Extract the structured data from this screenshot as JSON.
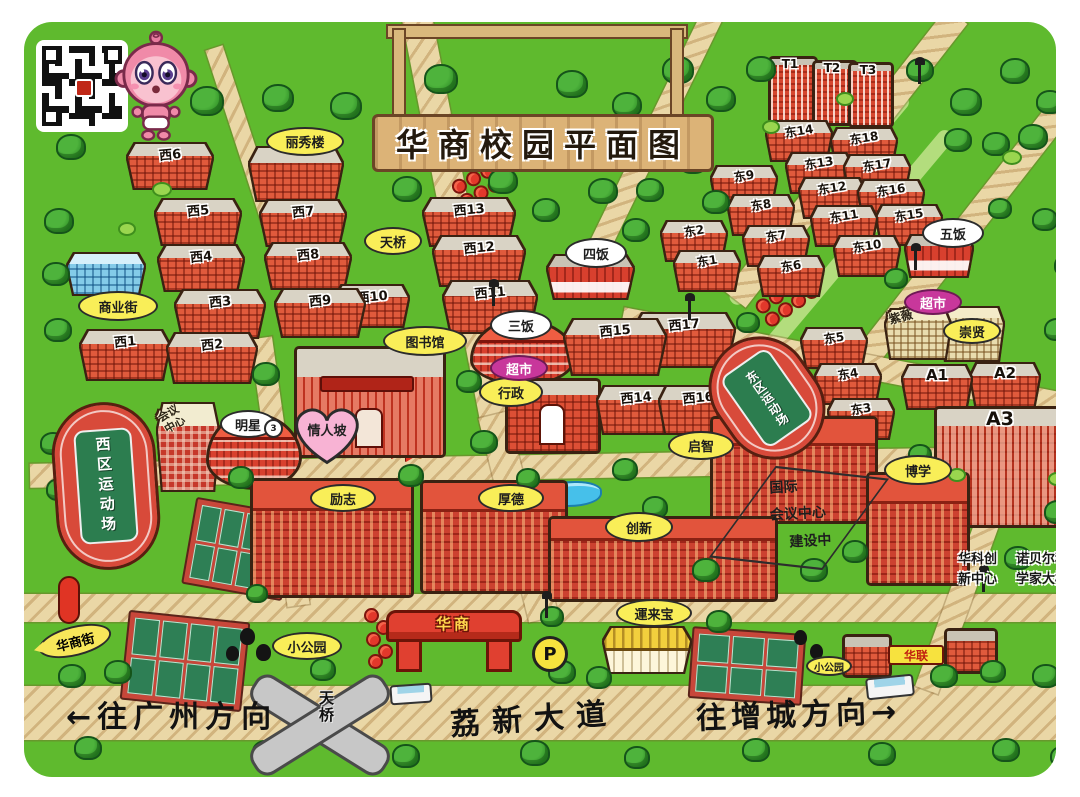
{
  "sign": {
    "title": "华商校园平面图"
  },
  "gate": {
    "label": "华商"
  },
  "parking": {
    "label": "P"
  },
  "bridge": {
    "label": "天桥"
  },
  "road_labels": {
    "to_guangzhou": "←往广州方向",
    "avenue": "荔新大道",
    "to_zengcheng": "往增城方向→"
  },
  "labels_special": {
    "lovers_slope": "情人坡",
    "huashang_street": "华商街"
  },
  "conference_center": {
    "lines": [
      "国际",
      "会议中心",
      "建设中"
    ]
  },
  "annotations": {
    "huake": [
      "华科创",
      "新中心"
    ],
    "nobel": [
      "诺贝尔科",
      "学家大楼"
    ]
  },
  "fields": [
    {
      "label": "西区运动场"
    },
    {
      "label": "东区运动场"
    }
  ],
  "colors": {
    "grass": "#5fba2e",
    "road": "#ead7a6",
    "building_red": "#e05a3c",
    "bubble_yellow": "#f9ee58",
    "bubble_purple": "#c8379b",
    "track_red": "#d84a3a"
  },
  "buildings": [
    {
      "n": "T1",
      "x": 768,
      "y": 56,
      "w": 44,
      "h": 62,
      "s": "t"
    },
    {
      "n": "T2",
      "x": 812,
      "y": 60,
      "w": 40,
      "h": 60,
      "s": "t"
    },
    {
      "n": "T3",
      "x": 848,
      "y": 62,
      "w": 40,
      "h": 60,
      "s": "t"
    },
    {
      "n": "西6",
      "x": 128,
      "y": 144,
      "w": 84,
      "h": 44,
      "s": "w"
    },
    {
      "n": "",
      "x": 250,
      "y": 148,
      "w": 92,
      "h": 52,
      "s": "w"
    },
    {
      "n": "西5",
      "x": 156,
      "y": 200,
      "w": 84,
      "h": 44,
      "s": "w"
    },
    {
      "n": "西7",
      "x": 261,
      "y": 201,
      "w": 84,
      "h": 44,
      "s": "w"
    },
    {
      "n": "西4",
      "x": 159,
      "y": 246,
      "w": 84,
      "h": 44,
      "s": "w"
    },
    {
      "n": "西8",
      "x": 266,
      "y": 244,
      "w": 84,
      "h": 44,
      "s": "w"
    },
    {
      "n": "",
      "x": 68,
      "y": 254,
      "w": 76,
      "h": 40,
      "s": "blue"
    },
    {
      "n": "西3",
      "x": 176,
      "y": 291,
      "w": 88,
      "h": 46,
      "s": "w"
    },
    {
      "n": "西9",
      "x": 276,
      "y": 290,
      "w": 88,
      "h": 46,
      "s": "w"
    },
    {
      "n": "西10",
      "x": 336,
      "y": 286,
      "w": 72,
      "h": 40,
      "s": "w"
    },
    {
      "n": "西1",
      "x": 81,
      "y": 331,
      "w": 88,
      "h": 48,
      "s": "w"
    },
    {
      "n": "西2",
      "x": 168,
      "y": 334,
      "w": 88,
      "h": 48,
      "s": "w"
    },
    {
      "n": "西13",
      "x": 424,
      "y": 199,
      "w": 90,
      "h": 46,
      "s": "w"
    },
    {
      "n": "西12",
      "x": 434,
      "y": 237,
      "w": 90,
      "h": 48,
      "s": "w"
    },
    {
      "n": "西11",
      "x": 444,
      "y": 282,
      "w": 92,
      "h": 50,
      "s": "w"
    },
    {
      "n": "西15",
      "x": 565,
      "y": 320,
      "w": 100,
      "h": 54,
      "s": "w"
    },
    {
      "n": "西17",
      "x": 634,
      "y": 314,
      "w": 100,
      "h": 52,
      "s": "w"
    },
    {
      "n": "西14",
      "x": 598,
      "y": 387,
      "w": 76,
      "h": 46,
      "s": "w"
    },
    {
      "n": "西16",
      "x": 660,
      "y": 387,
      "w": 76,
      "h": 46,
      "s": "w"
    },
    {
      "n": "东14",
      "x": 767,
      "y": 122,
      "w": 64,
      "h": 38,
      "s": "e"
    },
    {
      "n": "东18",
      "x": 832,
      "y": 129,
      "w": 64,
      "h": 38,
      "s": "e"
    },
    {
      "n": "东13",
      "x": 787,
      "y": 154,
      "w": 64,
      "h": 38,
      "s": "e"
    },
    {
      "n": "东17",
      "x": 845,
      "y": 156,
      "w": 64,
      "h": 38,
      "s": "e"
    },
    {
      "n": "东9",
      "x": 712,
      "y": 167,
      "w": 64,
      "h": 38,
      "s": "e"
    },
    {
      "n": "东12",
      "x": 800,
      "y": 179,
      "w": 64,
      "h": 38,
      "s": "e"
    },
    {
      "n": "东16",
      "x": 859,
      "y": 181,
      "w": 64,
      "h": 38,
      "s": "e"
    },
    {
      "n": "东8",
      "x": 729,
      "y": 196,
      "w": 64,
      "h": 38,
      "s": "e"
    },
    {
      "n": "东11",
      "x": 812,
      "y": 207,
      "w": 64,
      "h": 38,
      "s": "e"
    },
    {
      "n": "东15",
      "x": 877,
      "y": 206,
      "w": 64,
      "h": 38,
      "s": "e"
    },
    {
      "n": "东2",
      "x": 662,
      "y": 222,
      "w": 64,
      "h": 38,
      "s": "e"
    },
    {
      "n": "东7",
      "x": 744,
      "y": 227,
      "w": 64,
      "h": 38,
      "s": "e"
    },
    {
      "n": "东10",
      "x": 835,
      "y": 237,
      "w": 64,
      "h": 38,
      "s": "e"
    },
    {
      "n": "东1",
      "x": 675,
      "y": 252,
      "w": 64,
      "h": 38,
      "s": "e"
    },
    {
      "n": "东6",
      "x": 759,
      "y": 257,
      "w": 64,
      "h": 38,
      "s": "e"
    },
    {
      "n": "东5",
      "x": 802,
      "y": 329,
      "w": 64,
      "h": 38,
      "s": "e"
    },
    {
      "n": "东4",
      "x": 816,
      "y": 365,
      "w": 64,
      "h": 38,
      "s": "e"
    },
    {
      "n": "东3",
      "x": 829,
      "y": 400,
      "w": 64,
      "h": 38,
      "s": "e"
    },
    {
      "n": "",
      "x": 906,
      "y": 236,
      "w": 66,
      "h": 40,
      "s": "can"
    },
    {
      "n": "",
      "x": 548,
      "y": 256,
      "w": 85,
      "h": 42,
      "s": "can"
    },
    {
      "n": "",
      "x": 470,
      "y": 318,
      "w": 100,
      "h": 62,
      "s": "rnd"
    },
    {
      "n": "",
      "x": 886,
      "y": 310,
      "w": 64,
      "h": 48,
      "s": "tan",
      "rt": "紫薇"
    },
    {
      "n": "",
      "x": 941,
      "y": 308,
      "w": 62,
      "h": 52,
      "s": "tan"
    },
    {
      "n": "",
      "x": 294,
      "y": 346,
      "w": 146,
      "h": 106,
      "s": "lib"
    },
    {
      "n": "A1",
      "x": 903,
      "y": 366,
      "w": 68,
      "h": 42,
      "s": "a"
    },
    {
      "n": "A2",
      "x": 971,
      "y": 364,
      "w": 68,
      "h": 42,
      "s": "a"
    },
    {
      "n": "",
      "x": 505,
      "y": 378,
      "w": 90,
      "h": 70,
      "s": "adm"
    },
    {
      "n": "",
      "x": 158,
      "y": 404,
      "w": 60,
      "h": 86,
      "s": "chk",
      "rt": "会议\n中心"
    },
    {
      "n": "A3",
      "x": 934,
      "y": 406,
      "w": 132,
      "h": 116,
      "s": "a3"
    },
    {
      "n": "",
      "x": 206,
      "y": 412,
      "w": 90,
      "h": 72,
      "s": "rnd"
    },
    {
      "n": "",
      "x": 710,
      "y": 416,
      "w": 162,
      "h": 102,
      "s": "big"
    },
    {
      "n": "",
      "x": 866,
      "y": 472,
      "w": 98,
      "h": 108,
      "s": "big"
    },
    {
      "n": "",
      "x": 250,
      "y": 478,
      "w": 158,
      "h": 114,
      "s": "big"
    },
    {
      "n": "",
      "x": 420,
      "y": 480,
      "w": 142,
      "h": 108,
      "s": "big"
    },
    {
      "n": "",
      "x": 548,
      "y": 516,
      "w": 224,
      "h": 80,
      "s": "big"
    },
    {
      "n": "",
      "x": 604,
      "y": 628,
      "w": 86,
      "h": 44,
      "s": "yel"
    },
    {
      "n": "",
      "x": 842,
      "y": 634,
      "w": 44,
      "h": 38,
      "s": "sm"
    },
    {
      "n": "",
      "x": 944,
      "y": 628,
      "w": 48,
      "h": 40,
      "s": "sm"
    }
  ],
  "labels": [
    {
      "t": "丽秀楼",
      "k": "y",
      "x": 266,
      "y": 127,
      "w": 74,
      "h": 25
    },
    {
      "t": "商业街",
      "k": "y",
      "x": 78,
      "y": 291,
      "w": 76,
      "h": 26
    },
    {
      "t": "天桥",
      "k": "y",
      "x": 364,
      "y": 227,
      "w": 54,
      "h": 24
    },
    {
      "t": "图书馆",
      "k": "y",
      "x": 383,
      "y": 326,
      "w": 80,
      "h": 26
    },
    {
      "t": "行政",
      "k": "y",
      "x": 479,
      "y": 377,
      "w": 60,
      "h": 26
    },
    {
      "t": "启智",
      "k": "y",
      "x": 668,
      "y": 431,
      "w": 62,
      "h": 25
    },
    {
      "t": "厚德",
      "k": "y",
      "x": 478,
      "y": 484,
      "w": 62,
      "h": 24
    },
    {
      "t": "创新",
      "k": "y",
      "x": 605,
      "y": 512,
      "w": 64,
      "h": 26
    },
    {
      "t": "励志",
      "k": "y",
      "x": 310,
      "y": 484,
      "w": 62,
      "h": 24
    },
    {
      "t": "博学",
      "k": "y",
      "x": 884,
      "y": 455,
      "w": 64,
      "h": 26
    },
    {
      "t": "崇贤",
      "k": "y",
      "x": 943,
      "y": 318,
      "w": 54,
      "h": 22
    },
    {
      "t": "小公园",
      "k": "y",
      "x": 272,
      "y": 632,
      "w": 66,
      "h": 24
    },
    {
      "t": "小公园",
      "k": "y",
      "x": 806,
      "y": 656,
      "w": 42,
      "h": 16,
      "fs": 10
    },
    {
      "t": "運来宝",
      "k": "y",
      "x": 616,
      "y": 599,
      "w": 72,
      "h": 24
    },
    {
      "t": "三饭",
      "k": "w",
      "x": 490,
      "y": 310,
      "w": 58,
      "h": 26
    },
    {
      "t": "四饭",
      "k": "w",
      "x": 565,
      "y": 238,
      "w": 58,
      "h": 26
    },
    {
      "t": "五饭",
      "k": "w",
      "x": 922,
      "y": 218,
      "w": 58,
      "h": 26
    },
    {
      "t": "明星",
      "k": "w",
      "x": 220,
      "y": 410,
      "w": 52,
      "h": 24
    },
    {
      "t": "3",
      "k": "c3",
      "x": 264,
      "y": 419,
      "w": 15,
      "h": 15
    },
    {
      "t": "超市",
      "k": "p",
      "x": 490,
      "y": 355,
      "w": 54,
      "h": 22
    },
    {
      "t": "超市",
      "k": "p",
      "x": 904,
      "y": 289,
      "w": 54,
      "h": 22
    },
    {
      "t": "华联",
      "k": "s",
      "x": 888,
      "y": 645,
      "w": 52,
      "h": 16,
      "fs": 12
    }
  ],
  "decor": {
    "roads": [
      [
        0,
        686,
        1080,
        54,
        0
      ],
      [
        0,
        594,
        1080,
        28,
        0
      ],
      [
        30,
        455,
        1010,
        24,
        -1
      ],
      [
        402,
        18,
        30,
        430,
        -11
      ],
      [
        478,
        415,
        30,
        210,
        -14
      ],
      [
        205,
        48,
        18,
        300,
        -18
      ],
      [
        944,
        16,
        26,
        360,
        38
      ],
      [
        1072,
        78,
        26,
        440,
        38
      ],
      [
        702,
        14,
        22,
        310,
        26
      ],
      [
        618,
        352,
        470,
        24,
        11
      ],
      [
        1000,
        455,
        24,
        250,
        20
      ],
      [
        250,
        338,
        22,
        270,
        -8
      ]
    ],
    "pale_roads": [
      [
        898,
        96,
        16,
        270,
        40
      ],
      [
        942,
        132,
        16,
        280,
        40
      ]
    ],
    "courts": [
      {
        "x": 188,
        "y": 505,
        "w": 88,
        "h": 74,
        "r": 10,
        "cols": 4,
        "rows": 2
      },
      {
        "x": 124,
        "y": 616,
        "w": 108,
        "h": 76,
        "r": 6,
        "cols": 4,
        "rows": 2
      },
      {
        "x": 690,
        "y": 630,
        "w": 100,
        "h": 58,
        "r": 4,
        "cols": 3,
        "rows": 2
      }
    ],
    "trees": [
      [
        50,
        88,
        30
      ],
      [
        86,
        56,
        26
      ],
      [
        190,
        86,
        30
      ],
      [
        262,
        84,
        28
      ],
      [
        56,
        134,
        26
      ],
      [
        330,
        92,
        28
      ],
      [
        424,
        64,
        30
      ],
      [
        556,
        70,
        28
      ],
      [
        612,
        92,
        26
      ],
      [
        662,
        56,
        28
      ],
      [
        706,
        86,
        26
      ],
      [
        746,
        56,
        26
      ],
      [
        950,
        88,
        28
      ],
      [
        1000,
        58,
        26
      ],
      [
        1018,
        124,
        26
      ],
      [
        982,
        132,
        24
      ],
      [
        944,
        128,
        24
      ],
      [
        1036,
        90,
        24
      ],
      [
        906,
        58,
        24
      ],
      [
        392,
        176,
        26
      ],
      [
        488,
        168,
        26
      ],
      [
        532,
        198,
        24
      ],
      [
        588,
        178,
        26
      ],
      [
        636,
        178,
        24
      ],
      [
        678,
        148,
        26
      ],
      [
        622,
        218,
        24
      ],
      [
        702,
        190,
        24
      ],
      [
        44,
        208,
        26
      ],
      [
        42,
        262,
        24
      ],
      [
        44,
        318,
        24
      ],
      [
        40,
        432,
        22
      ],
      [
        46,
        478,
        22
      ],
      [
        252,
        362,
        24
      ],
      [
        456,
        370,
        22
      ],
      [
        470,
        430,
        24
      ],
      [
        612,
        458,
        22
      ],
      [
        642,
        496,
        22
      ],
      [
        228,
        466,
        22
      ],
      [
        398,
        464,
        22
      ],
      [
        516,
        468,
        20
      ],
      [
        692,
        558,
        24
      ],
      [
        800,
        558,
        24
      ],
      [
        842,
        540,
        22
      ],
      [
        1004,
        546,
        24
      ],
      [
        1044,
        500,
        24
      ],
      [
        1058,
        558,
        22
      ],
      [
        908,
        444,
        20
      ],
      [
        884,
        268,
        20
      ],
      [
        1032,
        208,
        22
      ],
      [
        1054,
        254,
        22
      ],
      [
        988,
        198,
        20
      ],
      [
        1044,
        318,
        22
      ],
      [
        736,
        312,
        20
      ],
      [
        58,
        664,
        24
      ],
      [
        104,
        660,
        24
      ],
      [
        310,
        658,
        22
      ],
      [
        548,
        660,
        24
      ],
      [
        586,
        666,
        22
      ],
      [
        706,
        610,
        22
      ],
      [
        930,
        664,
        24
      ],
      [
        980,
        660,
        22
      ],
      [
        1032,
        664,
        24
      ],
      [
        1062,
        640,
        20
      ],
      [
        74,
        736,
        24
      ],
      [
        252,
        740,
        24
      ],
      [
        392,
        744,
        24
      ],
      [
        520,
        740,
        26
      ],
      [
        624,
        746,
        22
      ],
      [
        742,
        738,
        24
      ],
      [
        868,
        742,
        24
      ],
      [
        992,
        738,
        24
      ],
      [
        1050,
        746,
        20
      ],
      [
        540,
        606,
        20
      ],
      [
        246,
        584,
        18
      ]
    ],
    "bushes": [
      [
        152,
        182,
        16
      ],
      [
        118,
        222,
        14
      ],
      [
        1002,
        150,
        16
      ],
      [
        836,
        92,
        14
      ],
      [
        566,
        120,
        14
      ],
      [
        762,
        120,
        14
      ],
      [
        1048,
        472,
        14
      ],
      [
        948,
        468,
        14
      ]
    ],
    "dark_trees": [
      [
        240,
        628,
        15
      ],
      [
        256,
        644,
        15
      ],
      [
        226,
        646,
        13
      ],
      [
        794,
        630,
        13
      ],
      [
        810,
        644,
        13
      ]
    ],
    "flowers": [
      [
        364,
        608
      ],
      [
        376,
        620
      ],
      [
        366,
        632
      ],
      [
        378,
        644
      ],
      [
        368,
        654
      ]
    ],
    "flowerbeds": [
      {
        "x": 452,
        "y": 168,
        "w": 58,
        "h": 26,
        "r": -28,
        "n": 7
      },
      {
        "x": 754,
        "y": 274,
        "w": 94,
        "h": 34,
        "r": -35,
        "n": 9
      }
    ],
    "lamps": [
      [
        492,
        286
      ],
      [
        688,
        300
      ],
      [
        914,
        250
      ],
      [
        545,
        598
      ],
      [
        982,
        572
      ],
      [
        918,
        64
      ]
    ],
    "buses": [
      [
        390,
        684,
        38,
        16,
        -4
      ],
      [
        866,
        676,
        44,
        18,
        -6
      ]
    ],
    "pond": {
      "x": 538,
      "y": 481,
      "w": 60,
      "h": 22
    },
    "orange_bar": {
      "x": 413,
      "y": 422,
      "w": 11,
      "h": 32,
      "r": 18
    },
    "chevrons": [
      [
        378,
        438
      ],
      [
        392,
        441
      ],
      [
        406,
        444
      ]
    ],
    "red_pill": {
      "x": 58,
      "y": 576,
      "w": 18,
      "h": 44
    }
  }
}
